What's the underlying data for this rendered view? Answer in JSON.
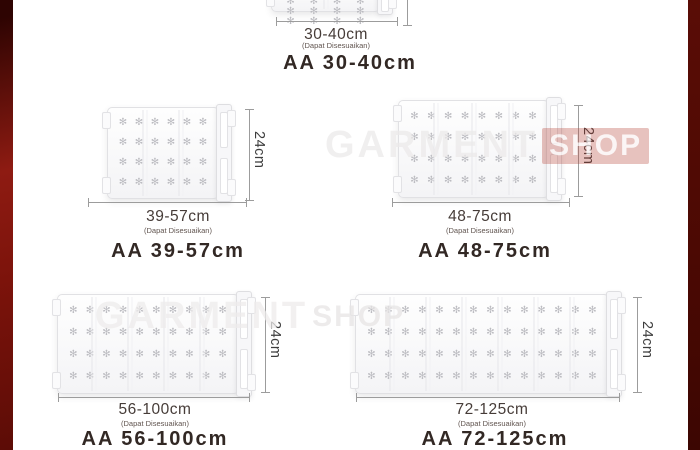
{
  "frame": {
    "background": "#ffffff",
    "left_bar_color": "#8e1b12",
    "right_bar_color": "#4c0903"
  },
  "labels": {
    "adjustable_note": "(Dapat Disesuaikan)",
    "height": "24cm"
  },
  "watermark": {
    "text": "GARMENT",
    "box_text": "SHOP",
    "accent": "#b23c30"
  },
  "flower_glyph": "✻",
  "products": [
    {
      "title": "AA 30-40cm",
      "size": "30-40cm",
      "height": "24cm",
      "rows": 4,
      "cols": 4,
      "sections": 2
    },
    {
      "title": "AA 39-57cm",
      "size": "39-57cm",
      "height": "24cm",
      "rows": 4,
      "cols": 6,
      "sections": 3
    },
    {
      "title": "AA 48-75cm",
      "size": "48-75cm",
      "height": "24cm",
      "rows": 4,
      "cols": 8,
      "sections": 4
    },
    {
      "title": "AA 56-100cm",
      "size": "56-100cm",
      "height": "24cm",
      "rows": 4,
      "cols": 10,
      "sections": 5
    },
    {
      "title": "AA 72-125cm",
      "size": "72-125cm",
      "height": "24cm",
      "rows": 4,
      "cols": 14,
      "sections": 7
    }
  ]
}
